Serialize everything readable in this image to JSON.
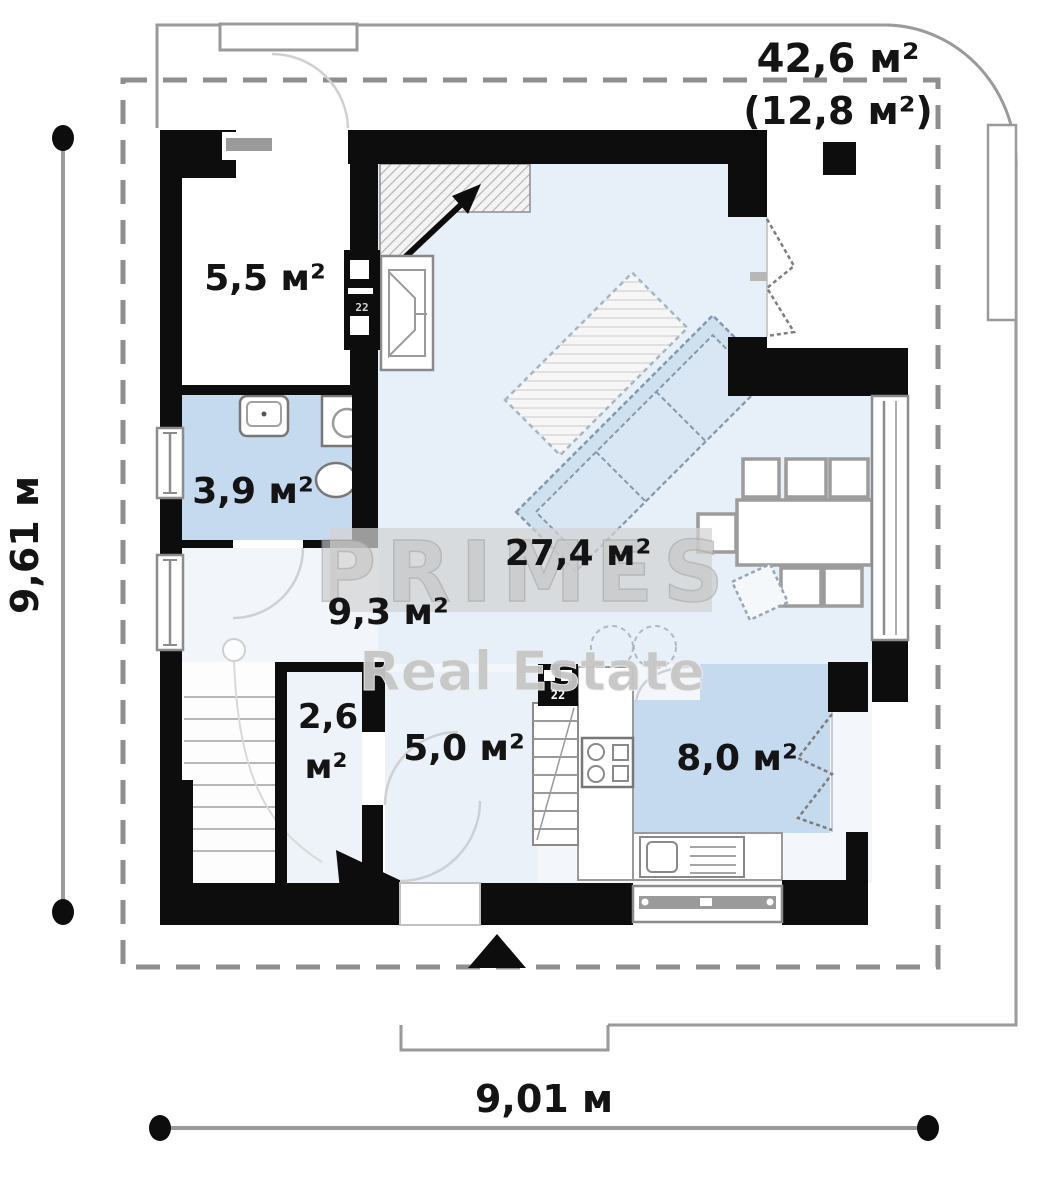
{
  "areas": {
    "terrace_total": "42,6 м²",
    "terrace_covered": "(12,8 м²)",
    "pantry": "5,5 м²",
    "bathroom": "3,9 м²",
    "living_room": "27,4 м²",
    "hall": "9,3 м²",
    "closet_line1": "2,6",
    "closet_line2": "м²",
    "vestibule": "5,0 м²",
    "kitchen": "8,0 м²"
  },
  "dimensions": {
    "vertical": "9,61 м",
    "horizontal": "9,01 м"
  },
  "watermark": {
    "brand": "PRIMES",
    "tagline": "Real Estate"
  },
  "flue_label": "22",
  "colors": {
    "wall": "#0d0d0d",
    "floor_living": "#e7eff8",
    "floor_wet": "#c5daee",
    "floor_hall": "#f2f6fa",
    "outline": "#9a9a9a",
    "boundary_dash": "#8e8e8e",
    "watermark_gray": "#c7c7c7",
    "label_text": "#141414"
  }
}
